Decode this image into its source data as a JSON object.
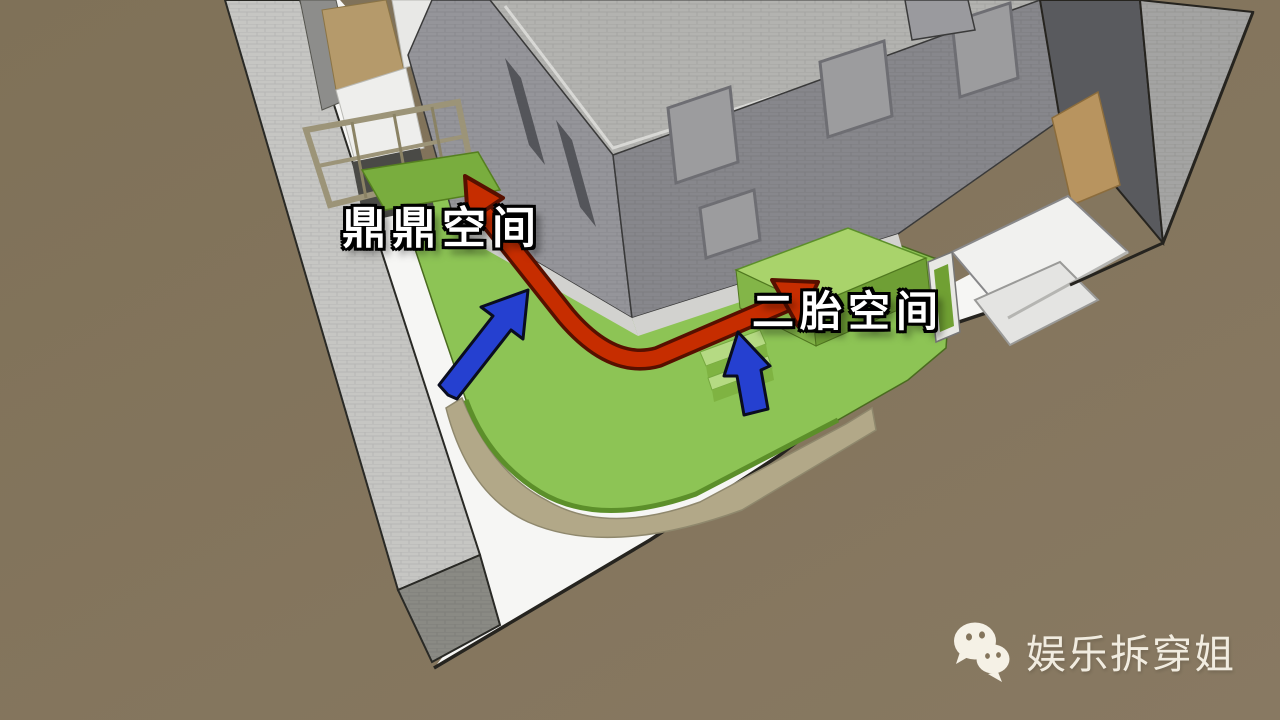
{
  "scene": {
    "type": "3d-architecture-annotation",
    "labels": [
      {
        "id": "dingding",
        "text": "鼎鼎空间"
      },
      {
        "id": "ertai",
        "text": "二胎空间"
      }
    ],
    "watermark": {
      "text": "娱乐拆穿姐",
      "icon": "wechat-icon"
    },
    "colors": {
      "ground": "#84755c",
      "walkway_white": "#f6f6f4",
      "boundary_wall": "#c6c6c3",
      "boundary_wall_end": "#8a8a84",
      "khaki_base": "#b2a888",
      "terrace_green": "#8dc455",
      "terrace_green_light": "#a9d36b",
      "terrace_green_dark": "#79ad3e",
      "building_left_facade": "#95959a",
      "building_right_facade": "#87878c",
      "roof_gray": "#b3b3b0",
      "neighbor_dark": "#595a5e",
      "neighbor_light": "#a4a4a3",
      "tan_wall": "#b8945f",
      "balcony_white": "#f1f1ef",
      "arrow_red": "#c62d00",
      "arrow_red_outline": "#571000",
      "arrow_blue": "#2540d0",
      "label_text": "#ffffff",
      "watermark_text": "#f1ece0"
    }
  }
}
